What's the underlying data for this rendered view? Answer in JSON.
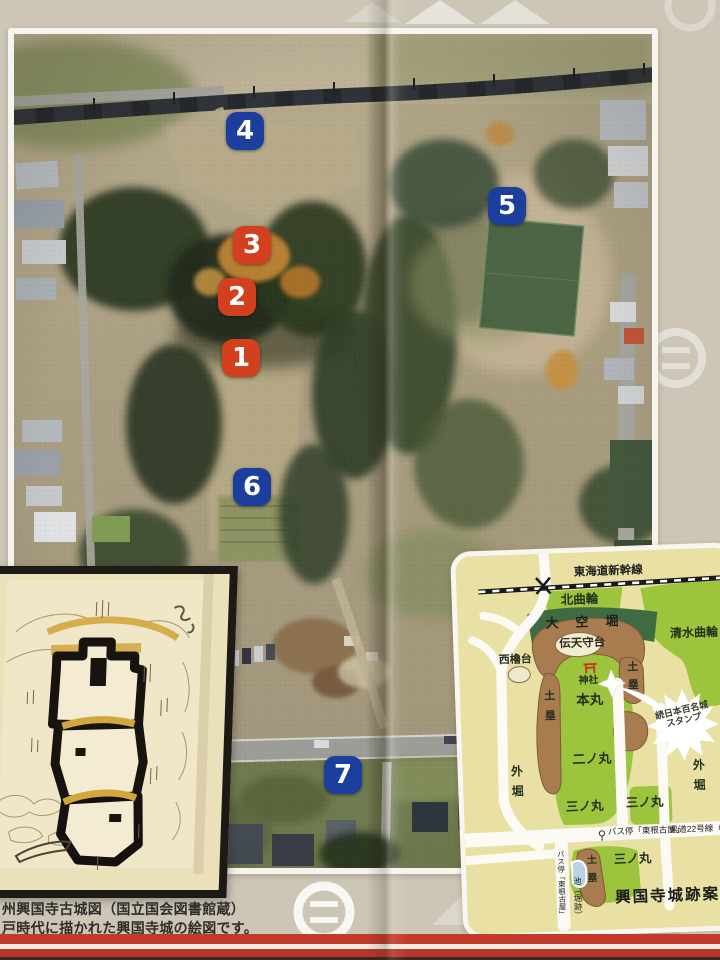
{
  "colors": {
    "background": "#cdc6b6",
    "marker_blue": "#1c3f9e",
    "marker_red": "#d2401f",
    "map_background": "#e9e0a4",
    "map_green": "#9cc43c",
    "map_dark_green": "#3f6b42",
    "map_brown": "#a97c50",
    "stripe_red": "#c23b2a"
  },
  "aerial": {
    "markers": [
      {
        "label": "4",
        "color": "blue"
      },
      {
        "label": "5",
        "color": "blue"
      },
      {
        "label": "3",
        "color": "red"
      },
      {
        "label": "2",
        "color": "red"
      },
      {
        "label": "1",
        "color": "red"
      },
      {
        "label": "6",
        "color": "blue"
      },
      {
        "label": "7",
        "color": "blue"
      }
    ]
  },
  "old_map": {
    "caption_line1": "州興国寺古城図（国立国会図書館蔵）",
    "caption_line2": "戸時代に描かれた興国寺城の絵図です。"
  },
  "site_map": {
    "title": "興国寺城跡案内",
    "shinkansen": "東海道新幹線",
    "kita_kuruwa": "北曲輪",
    "okarabori": "大空堀",
    "den_tenshudai": "伝天守台",
    "shimizu_kuruwa": "清水曲輪",
    "nishi_yagura_dai": "西櫓台",
    "jinja": "神社",
    "honmaru": "本丸",
    "dorui": "土塁",
    "ninomaru": "二ノ丸",
    "sotobori": "外堀",
    "sannomaru": "三ノ丸",
    "stamp_line1": "続日本百名城",
    "stamp_line2": "スタンプ",
    "bus_stop": "バス停「東根古屋」",
    "kendo": "県道22号線（根",
    "ike": "池（堀跡）"
  }
}
